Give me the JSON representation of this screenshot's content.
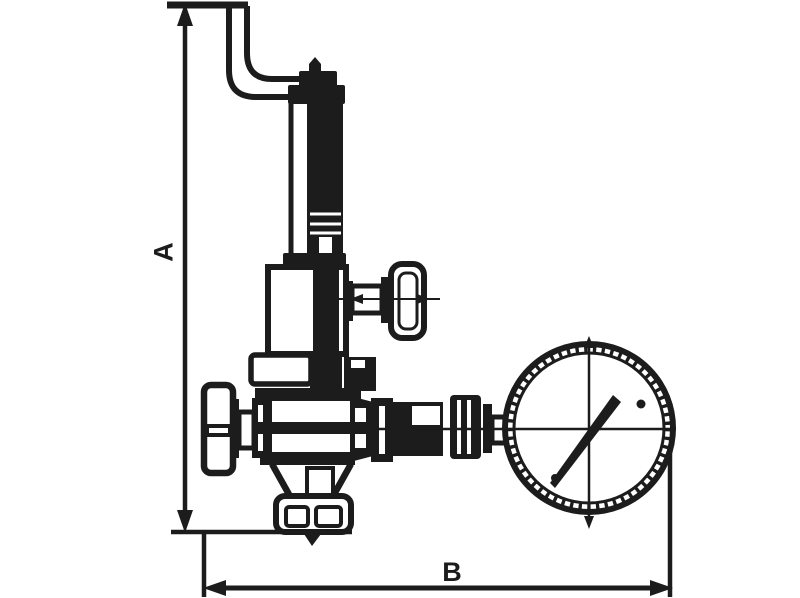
{
  "drawing": {
    "type": "technical-valve-diagram",
    "dimensions": {
      "vertical": {
        "label": "A"
      },
      "horizontal": {
        "label": "B"
      }
    },
    "colors": {
      "line": "#1c1c1c",
      "background": "#ffffff"
    }
  }
}
